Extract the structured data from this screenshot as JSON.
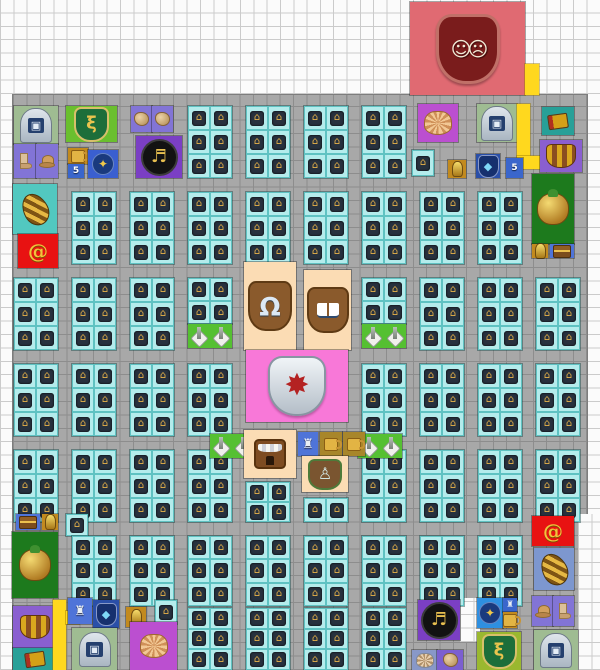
{
  "board": {
    "width": 600,
    "height": 670,
    "cell_w": 13.33,
    "cell_h": 13.4,
    "bg_color": "#fbfbfb",
    "grid_line_color": "#cbcbcb",
    "road_color": "#a8a8a8",
    "block_color": "#b4ecec",
    "yellow_road_color": "#ffd81e"
  },
  "glyphs": {
    "masks": "☺☹",
    "portal": "▣",
    "snake": "ξ",
    "clef": "♬",
    "bell": "Ω",
    "gear-shield": "✸",
    "droplet": "◆",
    "gem": "✦",
    "trophy": "♙",
    "statue": "♜",
    "statue-sm": "♜",
    "spiral": "@",
    "shrine": "⌂"
  },
  "roads": [
    {
      "x": 13,
      "y": 95,
      "w": 574,
      "h": 575
    }
  ],
  "cutouts": [
    {
      "x": 578,
      "y": 514,
      "w": 22,
      "h": 156
    },
    {
      "x": 460,
      "y": 598,
      "w": 20,
      "h": 44
    }
  ],
  "blocks": [
    {
      "x": 188,
      "y": 106
    },
    {
      "x": 246,
      "y": 106
    },
    {
      "x": 304,
      "y": 106
    },
    {
      "x": 362,
      "y": 106
    },
    {
      "x": 412,
      "y": 150,
      "w": 22,
      "h": 26
    },
    {
      "x": 72,
      "y": 192
    },
    {
      "x": 130,
      "y": 192
    },
    {
      "x": 188,
      "y": 192
    },
    {
      "x": 246,
      "y": 192
    },
    {
      "x": 304,
      "y": 192
    },
    {
      "x": 362,
      "y": 192
    },
    {
      "x": 420,
      "y": 192
    },
    {
      "x": 478,
      "y": 192
    },
    {
      "x": 14,
      "y": 278
    },
    {
      "x": 72,
      "y": 278
    },
    {
      "x": 130,
      "y": 278
    },
    {
      "x": 188,
      "y": 278,
      "w": 44,
      "h": 46
    },
    {
      "x": 362,
      "y": 278,
      "w": 44,
      "h": 46
    },
    {
      "x": 420,
      "y": 278
    },
    {
      "x": 478,
      "y": 278
    },
    {
      "x": 536,
      "y": 278
    },
    {
      "x": 14,
      "y": 364
    },
    {
      "x": 72,
      "y": 364
    },
    {
      "x": 130,
      "y": 364
    },
    {
      "x": 188,
      "y": 364
    },
    {
      "x": 362,
      "y": 364
    },
    {
      "x": 420,
      "y": 364
    },
    {
      "x": 478,
      "y": 364
    },
    {
      "x": 536,
      "y": 364
    },
    {
      "x": 14,
      "y": 450
    },
    {
      "x": 72,
      "y": 450
    },
    {
      "x": 130,
      "y": 450
    },
    {
      "x": 188,
      "y": 450
    },
    {
      "x": 246,
      "y": 482,
      "w": 44,
      "h": 40
    },
    {
      "x": 304,
      "y": 498,
      "w": 44,
      "h": 24
    },
    {
      "x": 362,
      "y": 450
    },
    {
      "x": 420,
      "y": 450
    },
    {
      "x": 478,
      "y": 450
    },
    {
      "x": 536,
      "y": 450
    },
    {
      "x": 66,
      "y": 514,
      "w": 22,
      "h": 22
    },
    {
      "x": 72,
      "y": 536,
      "h": 70
    },
    {
      "x": 130,
      "y": 536,
      "h": 70
    },
    {
      "x": 188,
      "y": 536,
      "h": 70
    },
    {
      "x": 246,
      "y": 536,
      "h": 70
    },
    {
      "x": 304,
      "y": 536,
      "h": 70
    },
    {
      "x": 362,
      "y": 536,
      "h": 70
    },
    {
      "x": 420,
      "y": 536,
      "h": 70
    },
    {
      "x": 478,
      "y": 536,
      "h": 70
    },
    {
      "x": 155,
      "y": 600,
      "w": 22,
      "h": 24
    },
    {
      "x": 188,
      "y": 608,
      "w": 44,
      "h": 62
    },
    {
      "x": 246,
      "y": 608,
      "w": 44,
      "h": 62
    },
    {
      "x": 304,
      "y": 608,
      "w": 44,
      "h": 62
    },
    {
      "x": 362,
      "y": 608,
      "w": 44,
      "h": 62
    }
  ],
  "tiles": [
    {
      "name": "theater-masks-plaza",
      "x": 410,
      "y": 2,
      "w": 115,
      "h": 93,
      "bg": "#e06a72",
      "icon": "masks"
    },
    {
      "name": "yellow-road-top",
      "x": 525,
      "y": 64,
      "w": 14,
      "h": 31,
      "bg": "#ffd81e",
      "icon": "none"
    },
    {
      "name": "portal-emblem-tile-tl",
      "x": 14,
      "y": 106,
      "w": 44,
      "h": 38,
      "bg": "#9fbc92",
      "icon": "portal"
    },
    {
      "name": "snake-crest-tile-tl",
      "x": 66,
      "y": 106,
      "w": 51,
      "h": 36,
      "bg": "#6abf2e",
      "icon": "snake"
    },
    {
      "name": "glove-tile-a",
      "x": 131,
      "y": 106,
      "w": 21,
      "h": 26,
      "bg": "#8274d6",
      "icon": "item-tan"
    },
    {
      "name": "glove-tile-b",
      "x": 152,
      "y": 106,
      "w": 21,
      "h": 26,
      "bg": "#8274d6",
      "icon": "item-tan"
    },
    {
      "name": "boot-tile-tl",
      "x": 14,
      "y": 144,
      "w": 22,
      "h": 34,
      "bg": "#8274d6",
      "icon": "boot"
    },
    {
      "name": "hat-tile-tl",
      "x": 36,
      "y": 144,
      "w": 22,
      "h": 34,
      "bg": "#8274d6",
      "icon": "hat"
    },
    {
      "name": "mug-tile-tl",
      "x": 68,
      "y": 148,
      "w": 20,
      "h": 16,
      "bg": "#c28a1e",
      "icon": "mug"
    },
    {
      "name": "number-tile-tl",
      "x": 68,
      "y": 164,
      "w": 16,
      "h": 14,
      "bg": "#3a66cc",
      "icon": "label",
      "label": "5"
    },
    {
      "name": "gem-shield-tile-tl",
      "x": 88,
      "y": 150,
      "w": 30,
      "h": 28,
      "bg": "#3a5fd0",
      "icon": "gem"
    },
    {
      "name": "music-clef-tile-tl",
      "x": 136,
      "y": 136,
      "w": 46,
      "h": 42,
      "bg": "#7b3fc4",
      "icon": "clef"
    },
    {
      "name": "shell-tile-tr",
      "x": 418,
      "y": 104,
      "w": 40,
      "h": 38,
      "bg": "#bb4fd0",
      "icon": "shell"
    },
    {
      "name": "portal-emblem-tile-tr",
      "x": 477,
      "y": 104,
      "w": 40,
      "h": 38,
      "bg": "#9fbc92",
      "icon": "portal"
    },
    {
      "name": "yellow-road-tr-v",
      "x": 517,
      "y": 104,
      "w": 13,
      "h": 52,
      "bg": "#ffd81e",
      "icon": "none"
    },
    {
      "name": "yellow-road-tr-h",
      "x": 517,
      "y": 156,
      "w": 40,
      "h": 13,
      "bg": "#ffd81e",
      "icon": "none"
    },
    {
      "name": "book-tile-tr",
      "x": 542,
      "y": 107,
      "w": 32,
      "h": 28,
      "bg": "#28a098",
      "icon": "book-item"
    },
    {
      "name": "basket-tile-tr",
      "x": 540,
      "y": 140,
      "w": 42,
      "h": 32,
      "bg": "#8a5fd0",
      "icon": "basket"
    },
    {
      "name": "lamp-tile-tr-a",
      "x": 448,
      "y": 160,
      "w": 18,
      "h": 18,
      "bg": "#c28a1e",
      "icon": "lamp"
    },
    {
      "name": "droplet-crest-tile-tr",
      "x": 476,
      "y": 154,
      "w": 24,
      "h": 24,
      "bg": "#2a4fa8",
      "icon": "droplet"
    },
    {
      "name": "number-tile-tr",
      "x": 506,
      "y": 158,
      "w": 17,
      "h": 20,
      "bg": "#3a66cc",
      "icon": "label",
      "label": "5"
    },
    {
      "name": "urn-tile-tr",
      "x": 532,
      "y": 174,
      "w": 42,
      "h": 70,
      "bg": "#1d7a1d",
      "icon": "urn"
    },
    {
      "name": "lamp-tile-tr-b",
      "x": 532,
      "y": 244,
      "w": 16,
      "h": 14,
      "bg": "#c28a1e",
      "icon": "lamp"
    },
    {
      "name": "chest-tile-tr",
      "x": 550,
      "y": 244,
      "w": 24,
      "h": 14,
      "bg": "#4f74d8",
      "icon": "chest"
    },
    {
      "name": "conch-tile-tl",
      "x": 13,
      "y": 184,
      "w": 44,
      "h": 50,
      "bg": "#52c8c0",
      "icon": "conch"
    },
    {
      "name": "spiral-tile-tl",
      "x": 18,
      "y": 234,
      "w": 40,
      "h": 34,
      "bg": "#e81212",
      "icon": "spiral"
    },
    {
      "name": "bell-plaza",
      "x": 244,
      "y": 262,
      "w": 52,
      "h": 88,
      "bg": "#fbdcb4",
      "icon": "bell"
    },
    {
      "name": "book-plaza",
      "x": 304,
      "y": 270,
      "w": 47,
      "h": 80,
      "bg": "#fbdcb4",
      "icon": "open-book"
    },
    {
      "name": "obelisk-tile-c3",
      "x": 188,
      "y": 324,
      "w": 44,
      "h": 24,
      "bg": "#55c032",
      "icon": "obelisk-pair"
    },
    {
      "name": "obelisk-tile-c6",
      "x": 362,
      "y": 324,
      "w": 44,
      "h": 24,
      "bg": "#55c032",
      "icon": "obelisk-pair"
    },
    {
      "name": "guild-plaza",
      "x": 246,
      "y": 350,
      "w": 102,
      "h": 72,
      "bg": "#f878d8",
      "icon": "gear-shield"
    },
    {
      "name": "obelisk-tile-e3",
      "x": 210,
      "y": 434,
      "w": 44,
      "h": 24,
      "bg": "#55c032",
      "icon": "obelisk-pair"
    },
    {
      "name": "obelisk-tile-e6",
      "x": 358,
      "y": 434,
      "w": 44,
      "h": 24,
      "bg": "#55c032",
      "icon": "obelisk-pair"
    },
    {
      "name": "storefront-plaza",
      "x": 244,
      "y": 430,
      "w": 52,
      "h": 48,
      "bg": "#fbdcb4",
      "icon": "storefront"
    },
    {
      "name": "statue-tile-center",
      "x": 298,
      "y": 432,
      "w": 20,
      "h": 24,
      "bg": "#4f74d8",
      "icon": "statue"
    },
    {
      "name": "mug-tile-center-a",
      "x": 320,
      "y": 432,
      "w": 22,
      "h": 24,
      "bg": "#a8862a",
      "icon": "mug"
    },
    {
      "name": "mug-tile-center-b",
      "x": 343,
      "y": 432,
      "w": 22,
      "h": 24,
      "bg": "#a8862a",
      "icon": "mug"
    },
    {
      "name": "trophy-plaza",
      "x": 302,
      "y": 456,
      "w": 46,
      "h": 36,
      "bg": "#fbdcb4",
      "icon": "trophy"
    },
    {
      "name": "chest-tile-bl",
      "x": 16,
      "y": 514,
      "w": 24,
      "h": 16,
      "bg": "#4f74d8",
      "icon": "chest"
    },
    {
      "name": "lamp-tile-bl-a",
      "x": 42,
      "y": 514,
      "w": 16,
      "h": 16,
      "bg": "#c28a1e",
      "icon": "lamp"
    },
    {
      "name": "urn-tile-bl",
      "x": 12,
      "y": 532,
      "w": 46,
      "h": 66,
      "bg": "#1d7a1d",
      "icon": "urn"
    },
    {
      "name": "basket-tile-bl",
      "x": 13,
      "y": 606,
      "w": 44,
      "h": 42,
      "bg": "#8a5fd0",
      "icon": "basket"
    },
    {
      "name": "book-tile-bl",
      "x": 13,
      "y": 648,
      "w": 44,
      "h": 22,
      "bg": "#28a098",
      "icon": "book-item"
    },
    {
      "name": "yellow-road-bl-v",
      "x": 53,
      "y": 600,
      "w": 13,
      "h": 70,
      "bg": "#ffd81e",
      "icon": "none"
    },
    {
      "name": "yellow-road-bl-c",
      "x": 66,
      "y": 611,
      "w": 13,
      "h": 13,
      "bg": "#ffd81e",
      "icon": "none"
    },
    {
      "name": "statue-tile-bl",
      "x": 68,
      "y": 598,
      "w": 24,
      "h": 26,
      "bg": "#4f74d8",
      "icon": "statue"
    },
    {
      "name": "droplet-crest-tile-bl",
      "x": 93,
      "y": 600,
      "w": 26,
      "h": 28,
      "bg": "#2a4fa8",
      "icon": "droplet"
    },
    {
      "name": "lamp-tile-bl-b",
      "x": 126,
      "y": 607,
      "w": 20,
      "h": 20,
      "bg": "#c28a1e",
      "icon": "lamp"
    },
    {
      "name": "portal-emblem-tile-bl",
      "x": 72,
      "y": 628,
      "w": 45,
      "h": 42,
      "bg": "#9fbc92",
      "icon": "portal"
    },
    {
      "name": "shell-tile-bl",
      "x": 130,
      "y": 622,
      "w": 47,
      "h": 48,
      "bg": "#bb4fd0",
      "icon": "shell"
    },
    {
      "name": "music-clef-tile-br",
      "x": 418,
      "y": 600,
      "w": 42,
      "h": 40,
      "bg": "#7b3fc4",
      "icon": "clef"
    },
    {
      "name": "shell-tile-br-small",
      "x": 412,
      "y": 650,
      "w": 25,
      "h": 20,
      "bg": "#8898c8",
      "icon": "shell-sm"
    },
    {
      "name": "moth-tile-br",
      "x": 437,
      "y": 650,
      "w": 26,
      "h": 20,
      "bg": "#7b5fd0",
      "icon": "item-tan"
    },
    {
      "name": "star-shield-tile-br",
      "x": 477,
      "y": 598,
      "w": 26,
      "h": 30,
      "bg": "#2e8fe0",
      "icon": "gem"
    },
    {
      "name": "banner-tile-br",
      "x": 503,
      "y": 598,
      "w": 14,
      "h": 14,
      "bg": "#3a66cc",
      "icon": "statue-sm"
    },
    {
      "name": "mug-tile-br",
      "x": 503,
      "y": 612,
      "w": 14,
      "h": 16,
      "bg": "#c28a1e",
      "icon": "mug"
    },
    {
      "name": "snake-crest-tile-br",
      "x": 477,
      "y": 632,
      "w": 44,
      "h": 38,
      "bg": "#9ab82f",
      "icon": "snake"
    },
    {
      "name": "hat-tile-br",
      "x": 532,
      "y": 596,
      "w": 21,
      "h": 30,
      "bg": "#8274d6",
      "icon": "hat"
    },
    {
      "name": "boot-tile-br",
      "x": 553,
      "y": 596,
      "w": 21,
      "h": 30,
      "bg": "#8274d6",
      "icon": "boot"
    },
    {
      "name": "portal-emblem-tile-br",
      "x": 534,
      "y": 630,
      "w": 44,
      "h": 40,
      "bg": "#9fbc92",
      "icon": "portal"
    },
    {
      "name": "spiral-tile-br",
      "x": 532,
      "y": 516,
      "w": 42,
      "h": 30,
      "bg": "#e81212",
      "icon": "spiral"
    },
    {
      "name": "conch-tile-br",
      "x": 534,
      "y": 548,
      "w": 40,
      "h": 42,
      "bg": "#7d97cf",
      "icon": "conch"
    }
  ]
}
